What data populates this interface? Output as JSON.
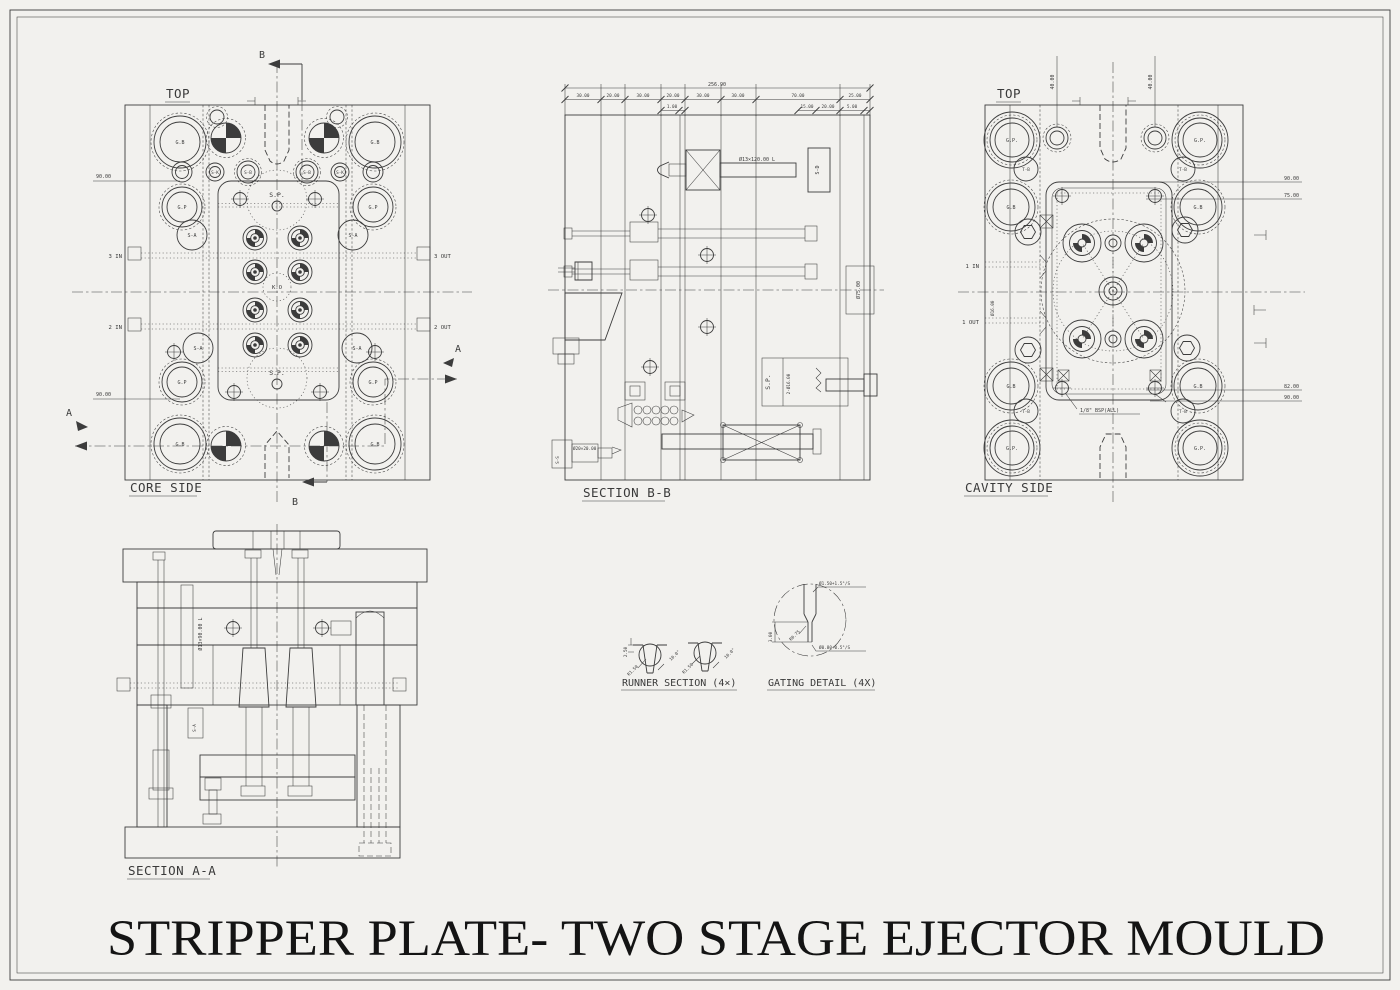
{
  "title": "STRIPPER PLATE- TWO STAGE EJECTOR MOULD",
  "colors": {
    "line": "#3c3c3c",
    "paper": "#f2f1ee",
    "text": "#3a3a3a"
  },
  "labels": {
    "gb": "G.B",
    "gp": "G.P",
    "gp_dot": "G.P.",
    "sa": "S-A",
    "sb": "S-B",
    "sk": "S-K",
    "tb": "T-B",
    "sd": "S-D",
    "ss": "S-S",
    "sp": "S.P.",
    "ko": "K.O",
    "top": "TOP"
  },
  "core_side": {
    "view_label": "CORE SIDE",
    "water_3_in": "3 IN",
    "water_3_out": "3 OUT",
    "water_2_in": "2 IN",
    "water_2_out": "2 OUT",
    "dim_left_top": "90.00",
    "dim_left_bottom": "90.00",
    "marker_a": "A",
    "marker_b": "B"
  },
  "section_bb": {
    "view_label": "SECTION B-B",
    "dim_total": "256.90",
    "dims": [
      "30.00",
      "20.00",
      "30.00",
      "20.00",
      "30.00",
      "30.00",
      "70.00",
      "25.00"
    ],
    "sub_dims": [
      "1.00",
      "15.00",
      "20.00",
      "5.00"
    ],
    "shaft_label": "Ø13×120.00 L",
    "dia_75": "Ø75.00",
    "dia_16": "2-Ø16.00",
    "dia_20": "Ø20×20.00"
  },
  "cavity_side": {
    "view_label": "CAVITY SIDE",
    "water_1_in": "1 IN",
    "water_1_out": "1 OUT",
    "dim_40_left": "40.00",
    "dim_40_right": "40.00",
    "dim_90_top": "90.00",
    "dim_75": "75.00",
    "dim_82": "82.00",
    "dim_90_bottom": "90.00",
    "dia_16": "Ø16.00",
    "bsp_note": "1/8\" BSP(ALL)"
  },
  "section_aa": {
    "view_label": "SECTION A-A",
    "shaft_label": "Ø13×90.00 L"
  },
  "runner_section": {
    "view_label": "RUNNER SECTION (4×)",
    "dim_depth": "2.50",
    "dim_radius": "R1.50",
    "dim_angle": "10.0°"
  },
  "gating_detail": {
    "view_label": "GATING DETAIL (4X)",
    "dim_top": "Ø1.50+1.5°/S",
    "dim_bottom": "Ø0.80+0.5°/S",
    "dim_land": "3.00",
    "dim_radius": "R0.75"
  }
}
